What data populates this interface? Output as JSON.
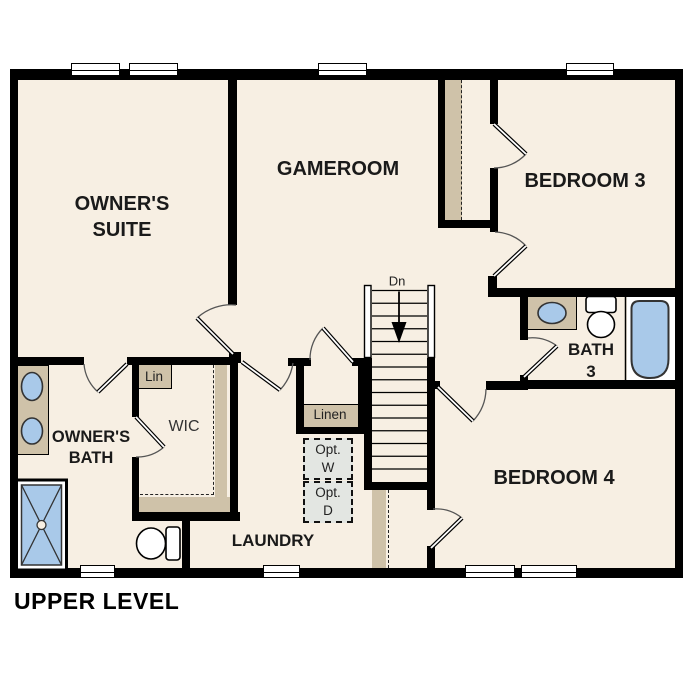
{
  "title": "UPPER LEVEL",
  "colors": {
    "floor": "#f7efe3",
    "wall": "#000000",
    "shelf": "#cfc2a9",
    "fixture_blue": "#a9c9e9",
    "appliance_gray": "#e3e6e2",
    "background": "#ffffff",
    "text": "#1a1a1a"
  },
  "rooms": {
    "owners_suite": {
      "line1": "OWNER'S",
      "line2": "SUITE"
    },
    "gameroom": {
      "label": "GAMEROOM"
    },
    "bedroom_3": {
      "label": "BEDROOM 3"
    },
    "bedroom_4": {
      "label": "BEDROOM 4"
    },
    "bath_3": {
      "line1": "BATH",
      "line2": "3"
    },
    "owners_bath": {
      "line1": "OWNER'S",
      "line2": "BATH"
    },
    "wic": {
      "label": "WIC"
    },
    "laundry": {
      "label": "LAUNDRY"
    }
  },
  "closets": {
    "linen_label": "Linen",
    "lin_label": "Lin"
  },
  "appliances": {
    "washer_line1": "Opt.",
    "washer_line2": "W",
    "dryer_line1": "Opt.",
    "dryer_line2": "D"
  },
  "stairs": {
    "down_label": "Dn"
  }
}
